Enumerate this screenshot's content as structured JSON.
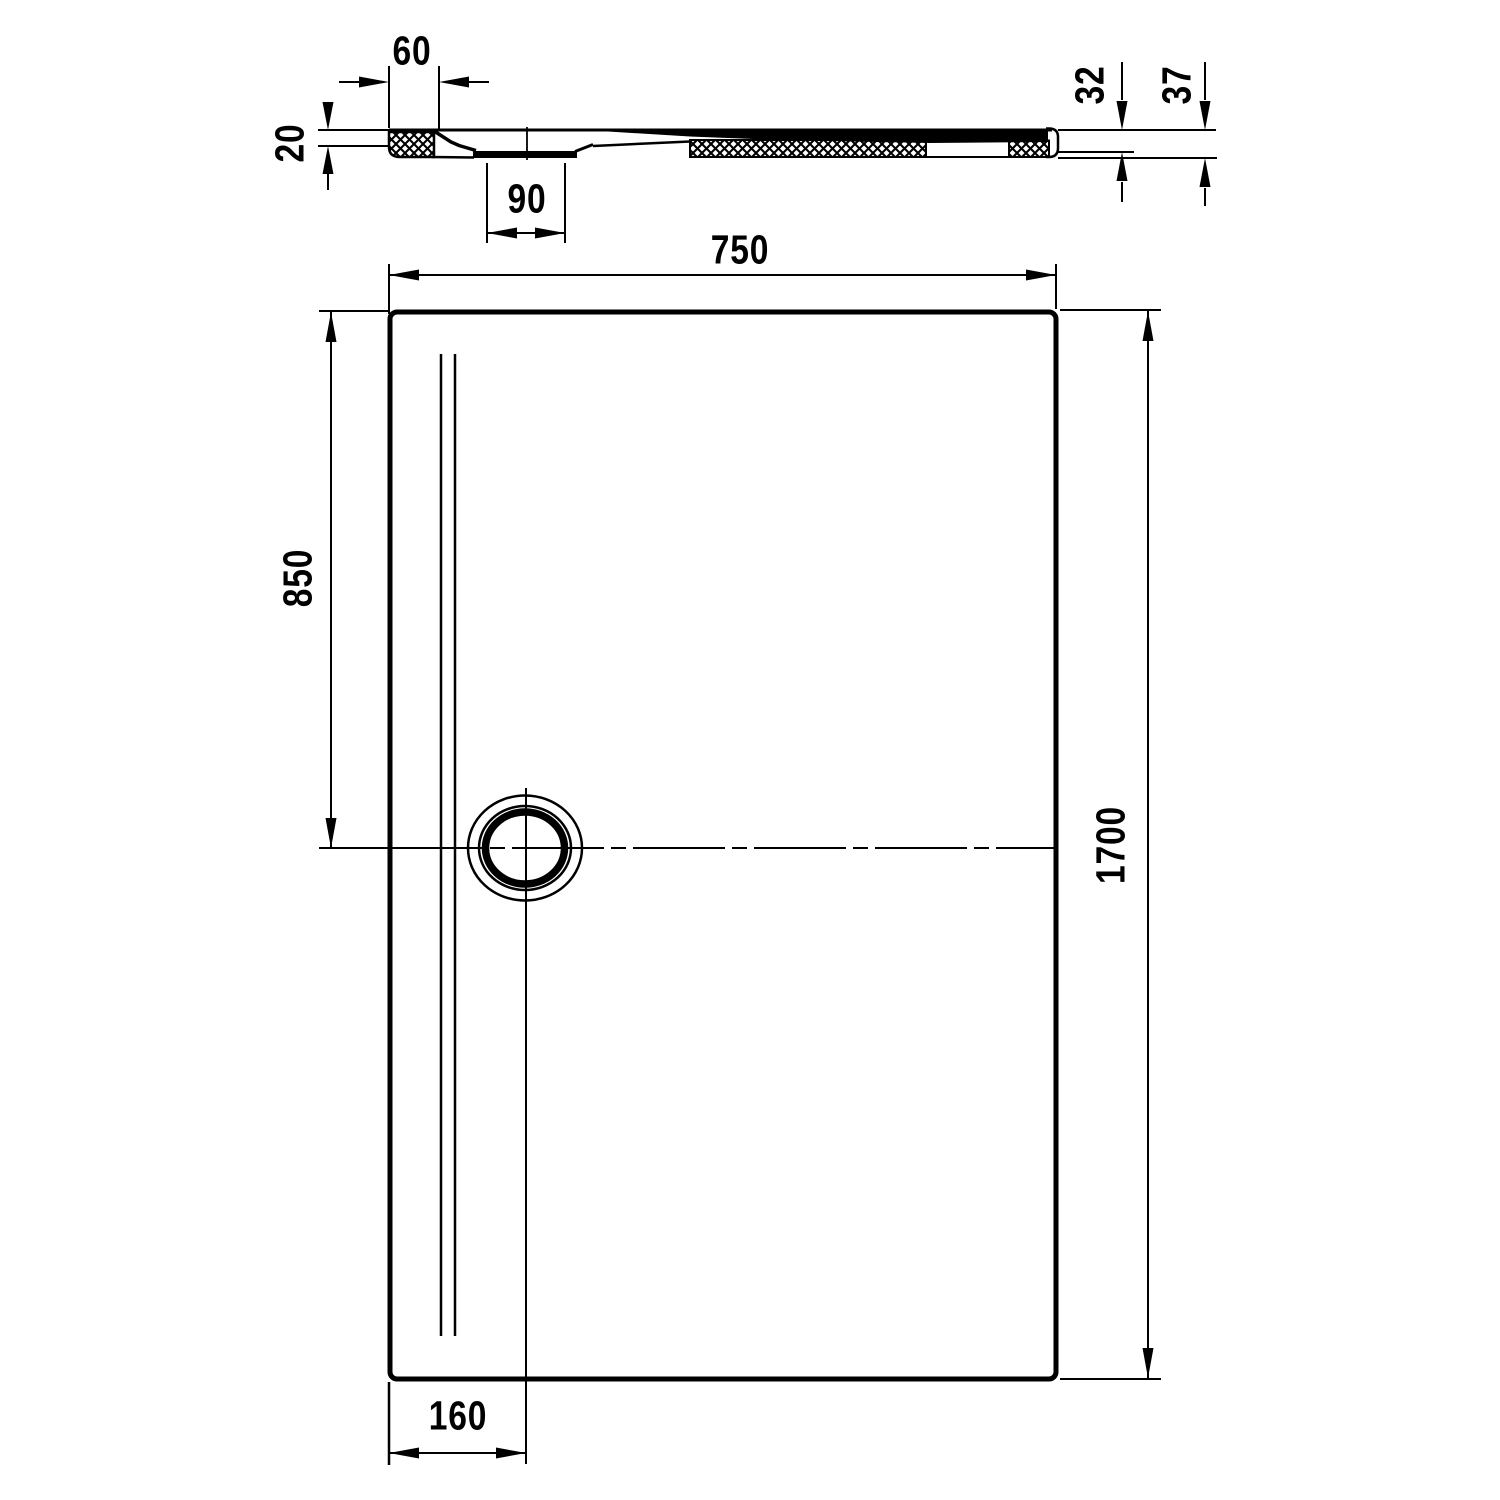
{
  "background_color": "#ffffff",
  "line_color": "#000000",
  "views": {
    "section": {
      "description": "shower-tray-section-profile",
      "dims": {
        "edge_offset": "60",
        "rim_thickness": "20",
        "recess_width": "90",
        "body_height": "32",
        "total_height": "37"
      }
    },
    "plan": {
      "description": "shower-tray-plan-view",
      "dims": {
        "width": "750",
        "drain_from_top": "850",
        "length": "1700",
        "drain_from_left": "160"
      }
    }
  }
}
